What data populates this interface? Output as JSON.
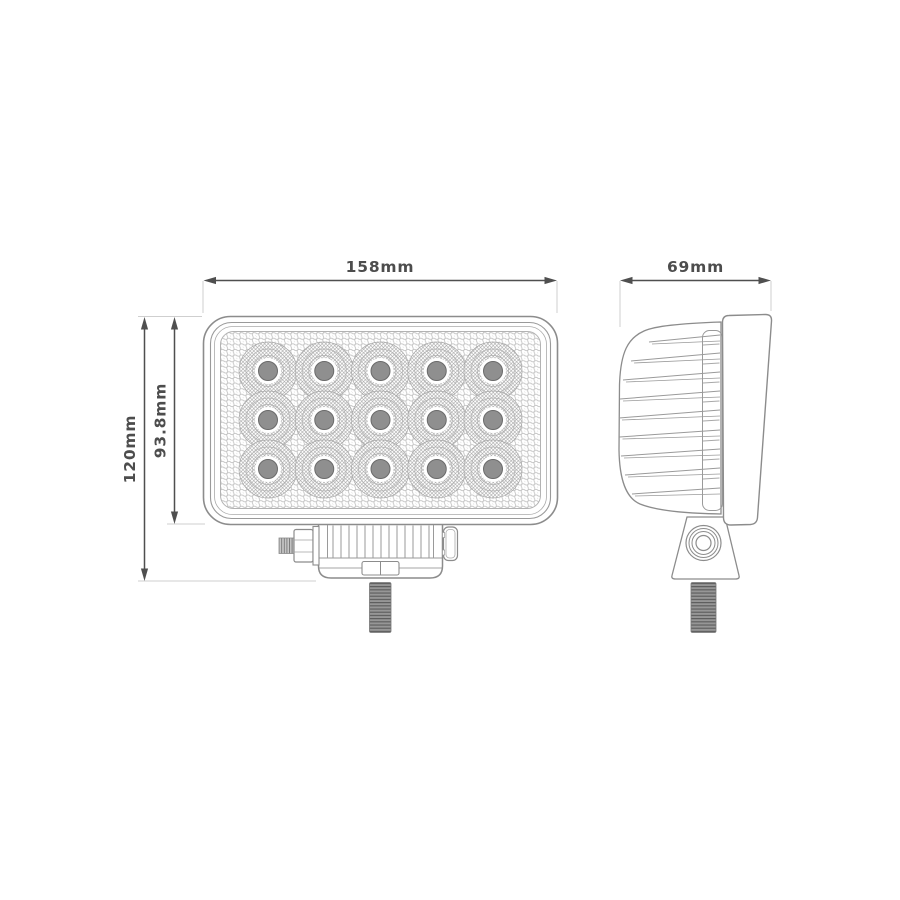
{
  "drawing": {
    "title_note": "",
    "dimensions": {
      "front_width": "158mm",
      "side_depth": "69mm",
      "overall_height": "120mm",
      "body_height": "93.8mm"
    },
    "front_view": {
      "led_rows": 3,
      "led_cols": 5,
      "led_total": 15
    },
    "colors": {
      "background": "#ffffff",
      "outline": "#8c8c8c",
      "detail_line": "#9a9a9a",
      "mesh_line": "#bfbfbf",
      "dim_line": "#4f4f4f",
      "dim_text": "#4d4d4d",
      "extension_line": "#cfcfcf",
      "stud_fill": "#8d8d8d",
      "led_center_fill": "#8f8f8f"
    }
  }
}
